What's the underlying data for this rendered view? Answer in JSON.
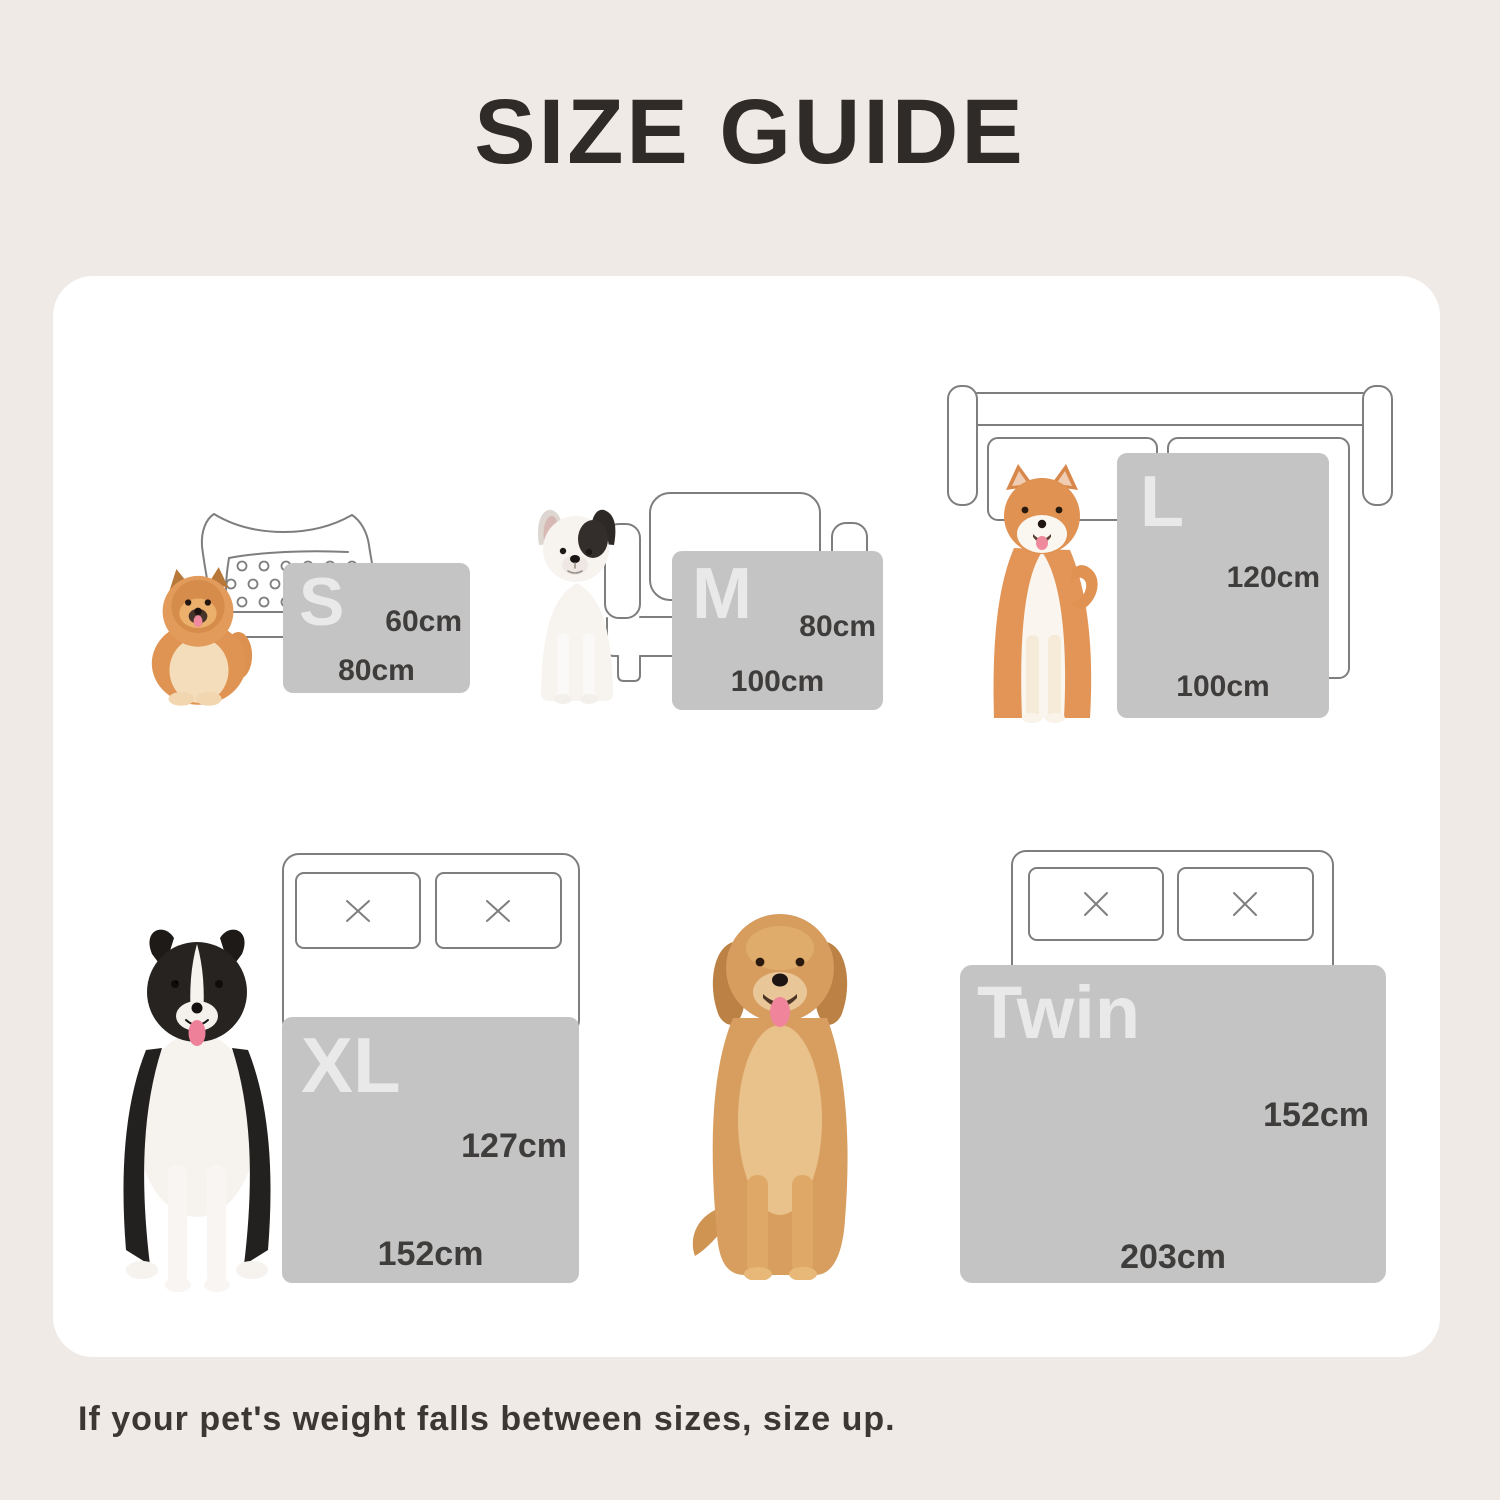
{
  "title": "SIZE GUIDE",
  "note": "If your pet's weight falls between sizes, size up.",
  "sections": [
    {
      "label": "S",
      "height": "60cm",
      "width": "80cm",
      "dog": "pomeranian",
      "furniture": "bolster pet bed"
    },
    {
      "label": "M",
      "height": "80cm",
      "width": "100cm",
      "dog": "french bulldog",
      "furniture": "armchair"
    },
    {
      "label": "L",
      "height": "120cm",
      "width": "100cm",
      "dog": "shiba inu",
      "furniture": "sofa"
    },
    {
      "label": "XL",
      "height": "127cm",
      "width": "152cm",
      "dog": "border collie",
      "furniture": "bed with two pillows"
    },
    {
      "label": "Twin",
      "height": "152cm",
      "width": "203cm",
      "dog": "golden retriever",
      "furniture": "bed with two pillows"
    }
  ],
  "colors": {
    "background": "#f0eae6",
    "card": "#ffffff",
    "blanket_swatch": "#c4c4c4",
    "swatch_letter": "#e9e9e9",
    "dimension_text": "#3f3d3c",
    "title_text": "#2e2b29",
    "line_art": "#7e7e7e"
  }
}
